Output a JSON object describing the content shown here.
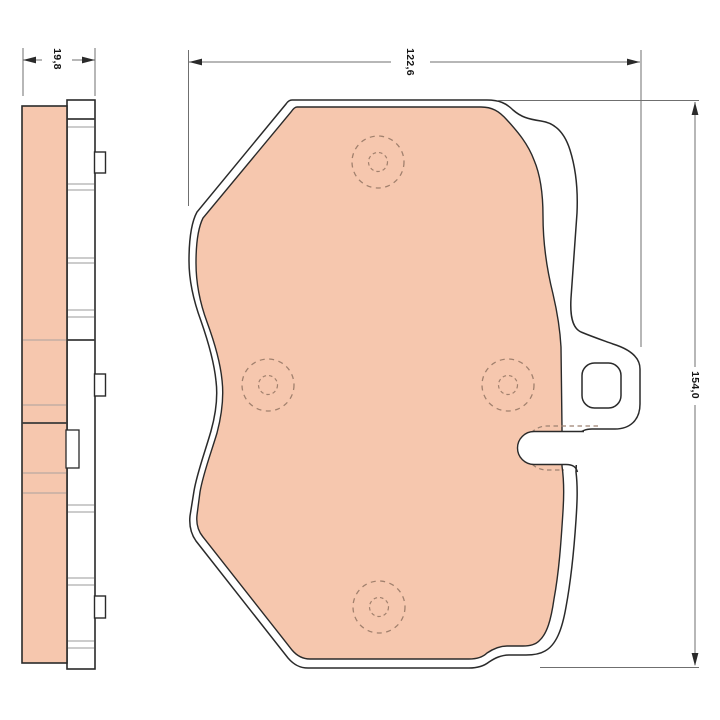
{
  "drawing": {
    "dim_thickness": {
      "label": "19,8"
    },
    "dim_width": {
      "label": "122,6"
    },
    "dim_height": {
      "label": "154,0"
    },
    "colors": {
      "friction_material": "#f6c7ae",
      "outline": "#2a2a2a",
      "detail_line": "#999999",
      "dimension_line": "#6f6f6f",
      "hidden_line": "#a1806d",
      "background": "#ffffff"
    }
  }
}
